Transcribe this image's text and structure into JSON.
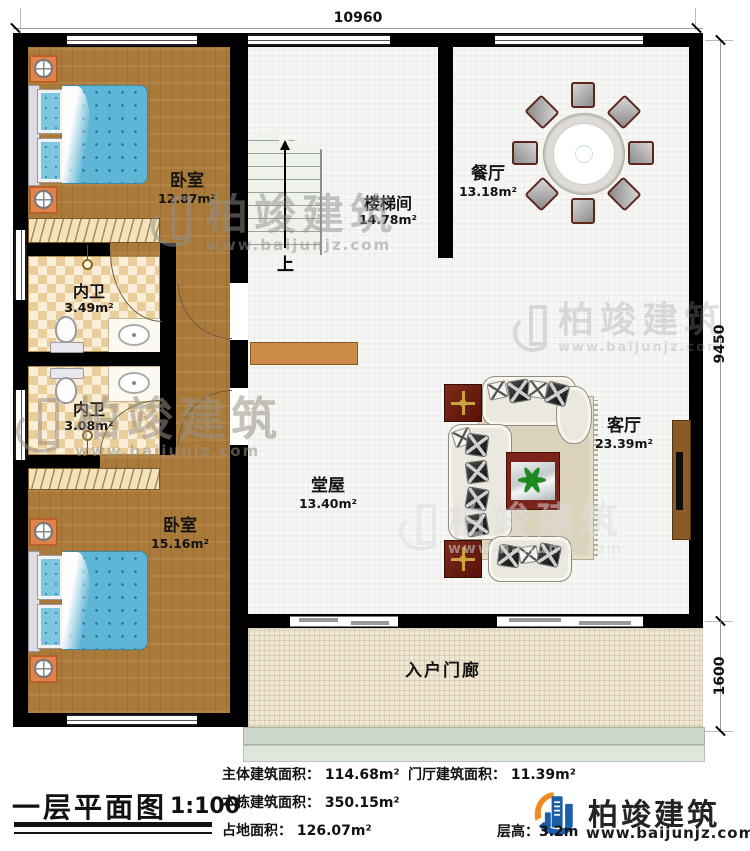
{
  "dimensions": {
    "width_top": "10960",
    "height_right": "9450",
    "porch_depth": "1600"
  },
  "rooms": {
    "bedroom1": {
      "name": "卧室",
      "area": "12.87m²"
    },
    "stairwell": {
      "name": "楼梯间",
      "area": "14.78m²",
      "up_label": "上"
    },
    "dining": {
      "name": "餐厅",
      "area": "13.18m²"
    },
    "bath1": {
      "name": "内卫",
      "area": "3.49m²"
    },
    "bath2": {
      "name": "内卫",
      "area": "3.08m²"
    },
    "bedroom2": {
      "name": "卧室",
      "area": "15.16m²"
    },
    "hall": {
      "name": "堂屋",
      "area": "13.40m²"
    },
    "living": {
      "name": "客厅",
      "area": "23.39m²"
    },
    "porch": {
      "name": "入户门廊"
    }
  },
  "title_block": {
    "title": "一层平面图",
    "scale": "1:100",
    "stats": {
      "main": "主体建筑面积： 114.68m²",
      "foyer": "门厅建筑面积： 11.39m²",
      "total": "本栋建筑面积： 350.15m²",
      "footprint": "占地面积： 126.07m²",
      "floor_height": "层高：3.2m"
    }
  },
  "brand": {
    "name": "柏竣建筑",
    "url": "www.baijunjz.com"
  },
  "colors": {
    "wall": "#000000",
    "wood_floor": "#aa7a3a",
    "tile": "#e9cd9b",
    "bed": "#5fb5d5",
    "accent_red": "#7c241c",
    "brand_blue": "#1b5ea8",
    "brand_orange": "#f28a1e"
  }
}
